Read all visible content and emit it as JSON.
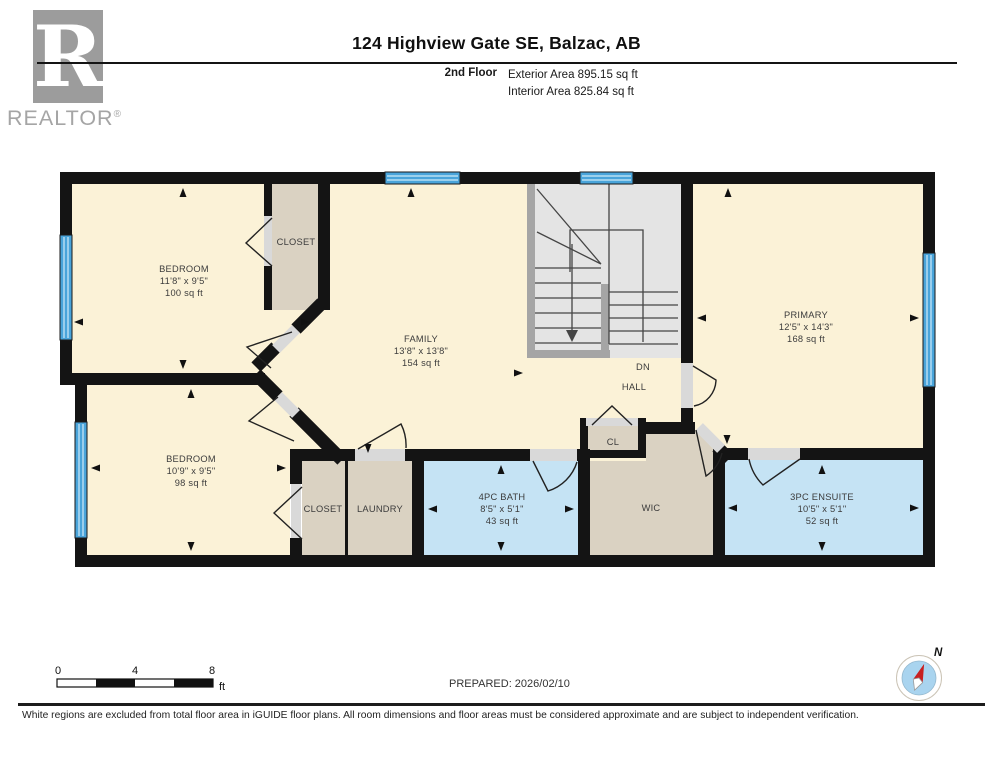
{
  "header": {
    "logo_letter": "R",
    "logo_wordmark": "REALTOR",
    "logo_reg": "®",
    "title": "124 Highview Gate SE, Balzac, AB",
    "floor_label": "2nd Floor",
    "exterior_area": "Exterior Area 895.15 sq ft",
    "interior_area": "Interior Area 825.84 sq ft"
  },
  "plan": {
    "rooms": {
      "bedroom1": {
        "name": "BEDROOM",
        "dims": "11'8\" x 9'5\"",
        "area": "100 sq ft"
      },
      "closet1": {
        "name": "CLOSET"
      },
      "family": {
        "name": "FAMILY",
        "dims": "13'8\" x 13'8\"",
        "area": "154 sq ft"
      },
      "primary": {
        "name": "PRIMARY",
        "dims": "12'5\" x 14'3\"",
        "area": "168 sq ft"
      },
      "dn_label": "DN",
      "hall_label": "HALL",
      "bedroom2": {
        "name": "BEDROOM",
        "dims": "10'9\" x 9'5\"",
        "area": "98 sq ft"
      },
      "closet2": {
        "name": "CLOSET"
      },
      "laundry": {
        "name": "LAUNDRY"
      },
      "bath": {
        "name": "4PC BATH",
        "dims": "8'5\" x 5'1\"",
        "area": "43 sq ft"
      },
      "cl": {
        "name": "CL"
      },
      "wic": {
        "name": "WIC"
      },
      "ensuite": {
        "name": "3PC ENSUITE",
        "dims": "10'5\" x 5'1\"",
        "area": "52 sq ft"
      }
    },
    "colors": {
      "wall": "#141414",
      "room_fill": "#FBF2D7",
      "closet_fill": "#DAD2C2",
      "wet_room_fill": "#C5E3F4",
      "window_blue": "#49A4DA",
      "stair_fill": "#E4E4E4",
      "stair_border": "#A5A5A5",
      "door_opening": "#D9D9D9"
    }
  },
  "footer": {
    "scale": {
      "t0": "0",
      "t4": "4",
      "t8": "8",
      "unit": "ft"
    },
    "prepared": "PREPARED: 2026/02/10",
    "compass_n": "N",
    "disclaimer": "White regions are excluded from total floor area in iGUIDE floor plans. All room dimensions and floor areas must be considered approximate and are subject to independent verification."
  }
}
